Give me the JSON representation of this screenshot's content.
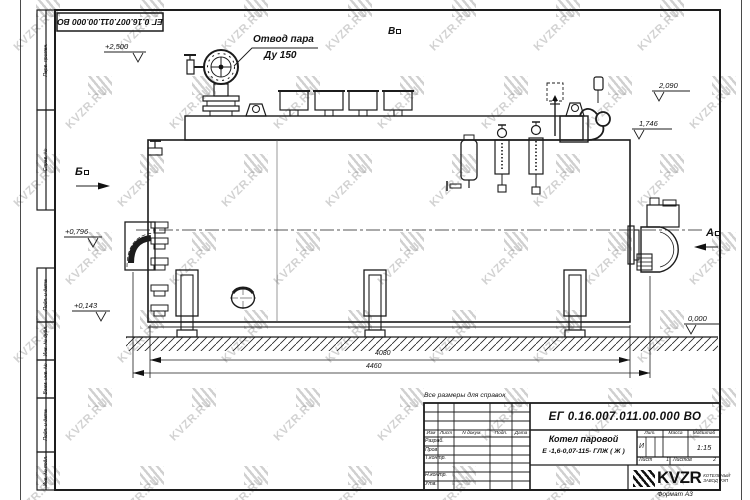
{
  "watermark": {
    "text": "KVZR.RU"
  },
  "frame": {
    "doc_number_top": "ЕГ 0.16.007.011.00.000  ВО",
    "side_labels": [
      "Перв. примен.",
      "Справ. №",
      "Подп. и дата",
      "Инв. № дубл.",
      "Взам. инв. №",
      "Подп. и дата",
      "Инв. № подл."
    ],
    "format_label": "Формат  А3"
  },
  "drawing": {
    "note": "Все размеры для справок",
    "callout_steam_line1": "Отвод пара",
    "callout_steam_line2": "Ду 150",
    "view_b_top": "В",
    "view_b_left": "Б",
    "view_a_right": "А",
    "elev_2500": "+2,500",
    "elev_2090": "2,090",
    "elev_1746": "1,746",
    "elev_0796": "+0,796",
    "elev_0143": "+0,143",
    "elev_0000": "0,000",
    "dim_4080": "4080",
    "dim_4460": "4460"
  },
  "titleblock": {
    "doc_number": "ЕГ 0.16.007.011.00.000  ВО",
    "product_name": "Котел паровой",
    "product_code": "Е -1,6-0,07-115- ГЛЖ ( Ж )",
    "col_izm": "Изм",
    "col_list": "Лист",
    "col_ndoc": "N докум.",
    "col_podp": "Подп.",
    "col_data": "Дата",
    "row_razrab": "Разраб.",
    "row_prov": "Пров.",
    "row_tkontr": "Т.контр.",
    "row_nkontr": "Н.контр.",
    "row_utv": "Утв.",
    "lit_label": "Лит.",
    "mass_label": "Масса",
    "scale_label": "Масштаб",
    "lit_value": "И",
    "scale_value": "1:15",
    "sheet_label": "Лист",
    "sheet_num": "1",
    "sheets_label": "Листов",
    "sheets_num": "2",
    "brand": "KVZR",
    "brand_sub1": "КОТЕЛЬНЫЙ",
    "brand_sub2": "ЗАВОД РЭП"
  }
}
